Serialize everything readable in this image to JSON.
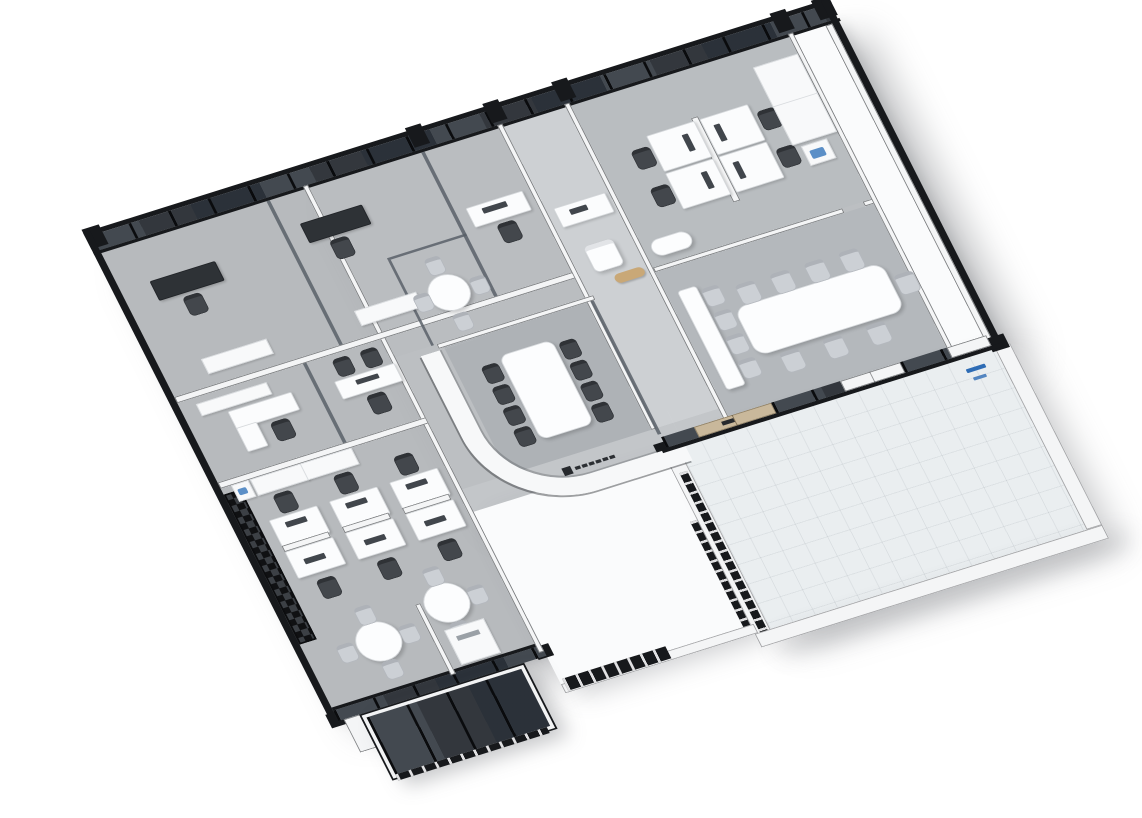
{
  "scene": {
    "type": "3d-isometric-office-floorplan-render",
    "background": "#ffffff",
    "colors": {
      "carpet_wing": "#b7babd",
      "carpet_main": "#bcbfc2",
      "carpet_meeting": "#aeb2b6",
      "carpet_conference": "#b4b8bc",
      "carpet_teamroom": "#b9bdc0",
      "carpet_core": "#babdc0",
      "corridor": "#cdd0d3",
      "hall": "#c3c6c9",
      "floor_white": "#fafbfc",
      "tile": "#eaeef0",
      "wall_black": "#17191c",
      "wall_white": "#f4f5f6",
      "glass_dark": "#262b31",
      "glass_partition": "#596068",
      "furniture_white": "#fbfcfd",
      "desk_dark": "#2e3236",
      "chair_dark": "#43474c",
      "chair_gray": "#ccd0d5",
      "wood_door": "#c9b89b",
      "bench_wood": "#c9a877",
      "accent_blue": "#2e6cb5",
      "printer_blue": "#5b8fc7",
      "logo_dark": "#26292d"
    },
    "rooms": [
      "glass-front-office-1",
      "glass-front-office-2",
      "private-office",
      "manager-office-a",
      "manager-office-b",
      "glass-meeting-nook",
      "open-plan-office",
      "central-meeting-room",
      "reception",
      "team-room",
      "large-conference-room",
      "east-room",
      "pantry",
      "entrance-lobby",
      "terrace-void",
      "balcony"
    ],
    "furniture": {
      "open_office_workstations": 6,
      "team_room_workstations": 4,
      "central_meeting_seats": 8,
      "conference_seats": 12,
      "breakout_round_tables": 2,
      "private_desks": 6,
      "printers": 1,
      "water_dispensers": 1,
      "sofas": 2
    },
    "logos": {
      "reception_wall": "company-logo-mark",
      "entrance_door": "company-logo-mark",
      "lobby_wall": "blue-logo-marks"
    }
  }
}
